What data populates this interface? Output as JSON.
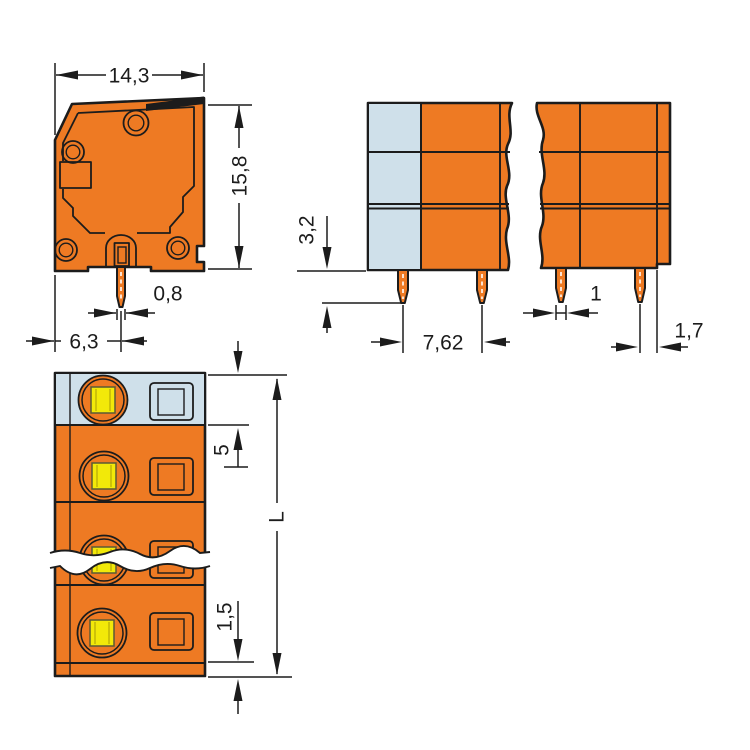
{
  "drawing": {
    "type": "technical-dimension-drawing",
    "component": "pcb-terminal-block",
    "dims": {
      "side_width": "14,3",
      "side_height": "15,8",
      "pin_width": "0,8",
      "pin_offset": "6,3",
      "pin_length": "3,2",
      "pin_pitch": "7,62",
      "pin_thickness": "1",
      "end_offset": "1,7",
      "pole_pitch": "5",
      "total_length": "L",
      "end_plate": "1,5"
    },
    "colors": {
      "body_orange": "#ee7a23",
      "marker_blue": "#cfe0ea",
      "screw_yellow": "#f2e909",
      "line": "#1c1c1c",
      "bg": "#ffffff"
    }
  }
}
